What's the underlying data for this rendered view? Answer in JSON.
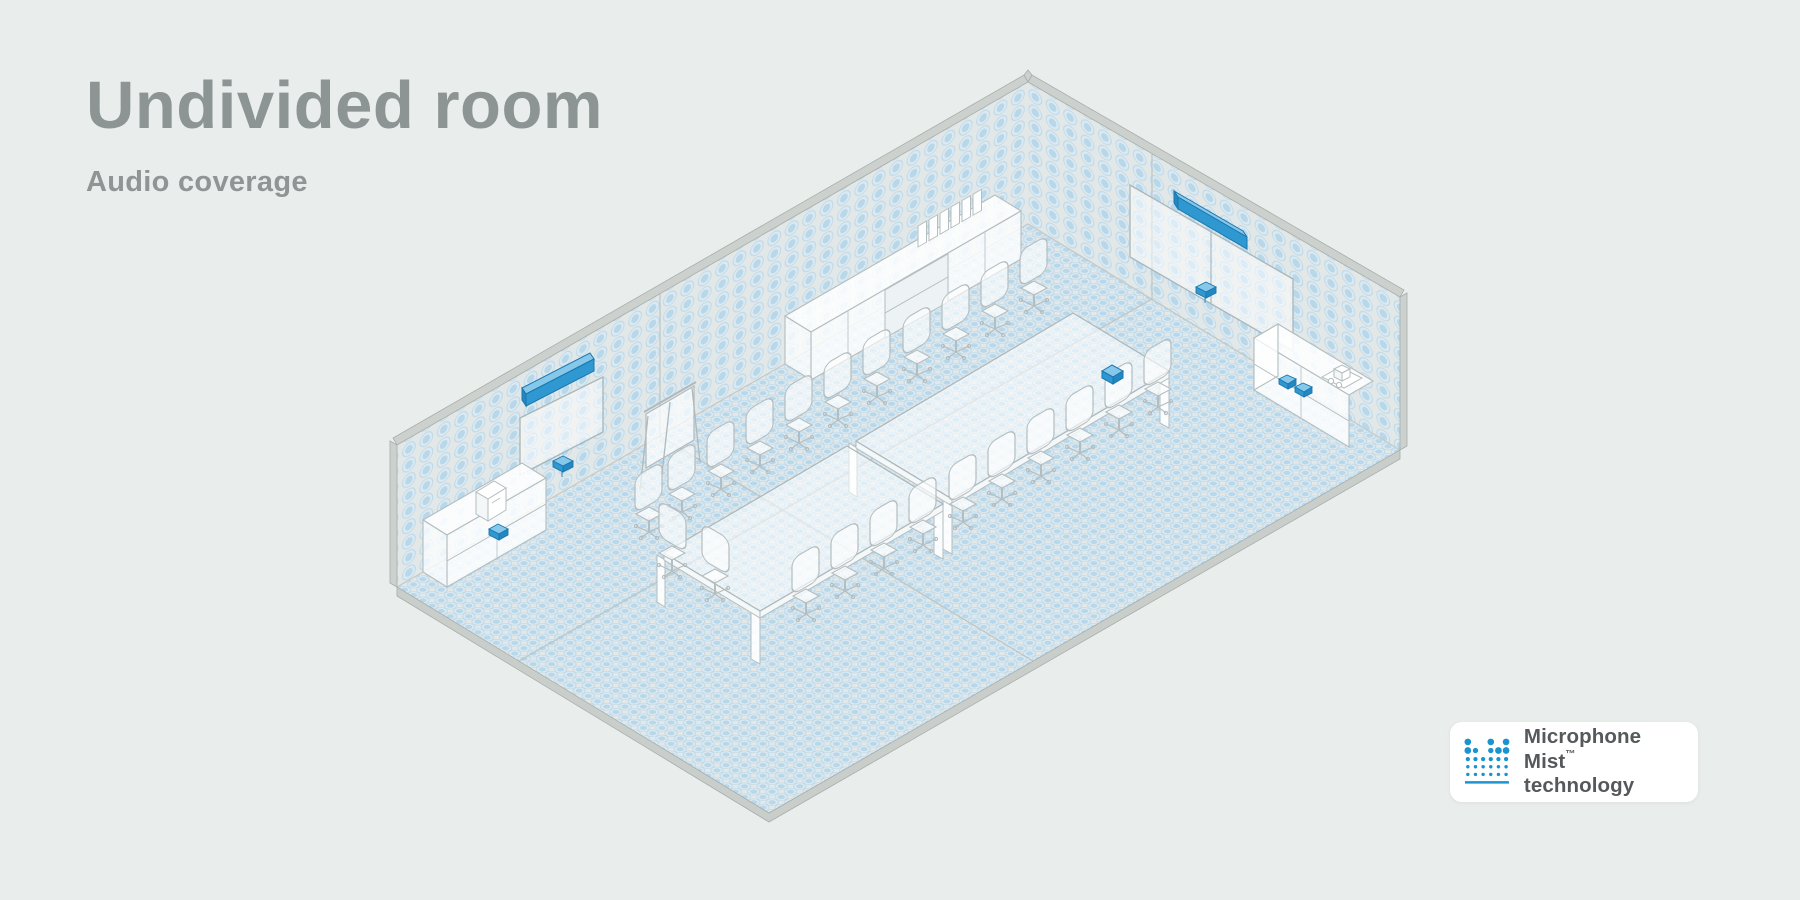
{
  "header": {
    "title": "Undivided room",
    "subtitle": "Audio coverage"
  },
  "badge": {
    "product": "Microphone Mist",
    "trademark": "™",
    "line2": "technology"
  },
  "colors": {
    "background": "#e9edec",
    "title_gray": "#8d9494",
    "accent_blue": "#2f98d1",
    "accent_blue_light": "#85c8ea",
    "accent_blue_dark": "#1b76ae",
    "coverage_dot_ring": "#bed9e8",
    "coverage_dot_outer": "#dbe9f2",
    "coverage_dot_inner": "#b2d4e7",
    "wall_fill": "#e2e7e7",
    "floor_fill": "#e4e8e7",
    "structure_gray": "#ccd1ce",
    "outline_gray": "#b4bdbf",
    "badge_text": "#56595b",
    "badge_logo_blue": "#1b93cf"
  },
  "room": {
    "description": "Isometric conference room shown undivided, with microphone mist audio coverage dots filling both walls and the entire floor",
    "coverage_style": "halftone mist dots on walls and floor",
    "devices": [
      {
        "name": "soundbar-left-wall",
        "color": "blue"
      },
      {
        "name": "camera-left-wall",
        "color": "blue"
      },
      {
        "name": "display-left-wall"
      },
      {
        "name": "soundbar-right-wall",
        "color": "blue"
      },
      {
        "name": "camera-right-wall",
        "color": "blue"
      },
      {
        "name": "dual-display-right-wall"
      },
      {
        "name": "tabletop-console",
        "color": "blue"
      },
      {
        "name": "credenza-device-left",
        "color": "blue"
      },
      {
        "name": "credenza-pucks-right",
        "color": "blue",
        "count": 2
      }
    ],
    "furniture": [
      {
        "name": "conference-table",
        "count": 2
      },
      {
        "name": "office-chair",
        "count": 23
      },
      {
        "name": "credenza-left",
        "items": [
          "coffee-machine",
          "blue-device"
        ]
      },
      {
        "name": "credenza-right",
        "items": [
          "kettle",
          "cups",
          "tray",
          "blue-pucks"
        ]
      },
      {
        "name": "wall-cabinet",
        "items": [
          "binders"
        ]
      },
      {
        "name": "flip-chart-easel"
      }
    ]
  }
}
